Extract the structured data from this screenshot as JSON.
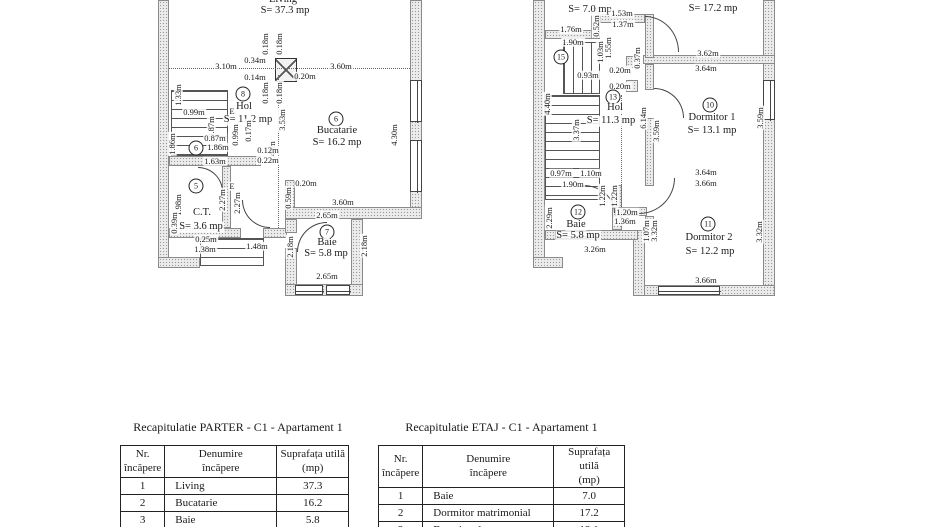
{
  "plans": {
    "parter": {
      "labels": [
        {
          "t": "Living",
          "k": "room",
          "x": 125,
          "y": 0
        },
        {
          "t": "S= 37.3 mp",
          "k": "area",
          "x": 127,
          "y": 11
        },
        {
          "t": "3.10m",
          "k": "dim",
          "x": 68,
          "y": 66
        },
        {
          "t": "0.34m",
          "k": "dim",
          "x": 97,
          "y": 60
        },
        {
          "t": "3.60m",
          "k": "dim",
          "x": 183,
          "y": 66
        },
        {
          "t": "0.14m",
          "k": "dim",
          "x": 97,
          "y": 77
        },
        {
          "t": "0.20m",
          "k": "dim",
          "x": 147,
          "y": 76
        },
        {
          "t": "0.18m",
          "k": "dimv",
          "x": 107,
          "y": 44
        },
        {
          "t": "0.18m",
          "k": "dimv",
          "x": 121,
          "y": 44
        },
        {
          "t": "0.18m",
          "k": "dimv",
          "x": 107,
          "y": 93
        },
        {
          "t": "0.18m",
          "k": "dimv",
          "x": 121,
          "y": 93
        },
        {
          "t": "8",
          "k": "circ",
          "x": 85,
          "y": 94
        },
        {
          "t": "Hol",
          "k": "room",
          "x": 86,
          "y": 107
        },
        {
          "t": "S= 11.2 mp",
          "k": "area",
          "x": 90,
          "y": 120
        },
        {
          "t": "3.53m",
          "k": "dimv",
          "x": 124,
          "y": 120
        },
        {
          "t": "5.45m",
          "k": "dimv",
          "x": 114,
          "y": 152
        },
        {
          "t": "6",
          "k": "circ",
          "x": 178,
          "y": 119
        },
        {
          "t": "Bucatarie",
          "k": "room",
          "x": 179,
          "y": 131
        },
        {
          "t": "S= 16.2 mp",
          "k": "area",
          "x": 179,
          "y": 143
        },
        {
          "t": "4.30m",
          "k": "dimv",
          "x": 236,
          "y": 135
        },
        {
          "t": "1.33m",
          "k": "dimv",
          "x": 20,
          "y": 95
        },
        {
          "t": "0.99m",
          "k": "dim",
          "x": 36,
          "y": 112
        },
        {
          "t": "E",
          "k": "dim",
          "x": 74,
          "y": 111
        },
        {
          "t": "0.87m",
          "k": "dimv",
          "x": 53,
          "y": 127
        },
        {
          "t": "0.87m",
          "k": "dim",
          "x": 57,
          "y": 138
        },
        {
          "t": "1.86m",
          "k": "dimv",
          "x": 14,
          "y": 144
        },
        {
          "t": "6",
          "k": "circ",
          "x": 38,
          "y": 148
        },
        {
          "t": "1.86m",
          "k": "dim",
          "x": 60,
          "y": 147
        },
        {
          "t": "0.99m",
          "k": "dimv",
          "x": 77,
          "y": 135
        },
        {
          "t": "0.17m",
          "k": "dimv",
          "x": 90,
          "y": 131
        },
        {
          "t": "0.12m",
          "k": "dim",
          "x": 110,
          "y": 150
        },
        {
          "t": "0.22m",
          "k": "dim",
          "x": 110,
          "y": 160
        },
        {
          "t": "1.63m",
          "k": "dim",
          "x": 57,
          "y": 161
        },
        {
          "t": "2.27m",
          "k": "dimv",
          "x": 64,
          "y": 200
        },
        {
          "t": "2.27m",
          "k": "dimv",
          "x": 79,
          "y": 203
        },
        {
          "t": "E",
          "k": "dim",
          "x": 74,
          "y": 186
        },
        {
          "t": "1.98m",
          "k": "dimv",
          "x": 20,
          "y": 205
        },
        {
          "t": "0.39m",
          "k": "dimv",
          "x": 16,
          "y": 223
        },
        {
          "t": "5",
          "k": "circ",
          "x": 38,
          "y": 186
        },
        {
          "t": "C.T.",
          "k": "room",
          "x": 44,
          "y": 213
        },
        {
          "t": "S= 3.6 mp",
          "k": "area",
          "x": 43,
          "y": 227
        },
        {
          "t": "0.25m",
          "k": "dim",
          "x": 48,
          "y": 239
        },
        {
          "t": "1.38m",
          "k": "dim",
          "x": 47,
          "y": 249
        },
        {
          "t": "1.48m",
          "k": "dim",
          "x": 99,
          "y": 246
        },
        {
          "t": "0.20m",
          "k": "dim",
          "x": 148,
          "y": 183
        },
        {
          "t": "0.59m",
          "k": "dimv",
          "x": 130,
          "y": 198
        },
        {
          "t": "3.60m",
          "k": "dim",
          "x": 185,
          "y": 202
        },
        {
          "t": "2.65m",
          "k": "dim",
          "x": 169,
          "y": 215
        },
        {
          "t": "7",
          "k": "circ",
          "x": 169,
          "y": 232
        },
        {
          "t": "Baie",
          "k": "room",
          "x": 169,
          "y": 243
        },
        {
          "t": "S= 5.8 mp",
          "k": "area",
          "x": 168,
          "y": 254
        },
        {
          "t": "2.18m",
          "k": "dimv",
          "x": 132,
          "y": 247
        },
        {
          "t": "2.18m",
          "k": "dimv",
          "x": 206,
          "y": 246
        },
        {
          "t": "2.65m",
          "k": "dim",
          "x": 169,
          "y": 276
        }
      ]
    },
    "etaj": {
      "labels": [
        {
          "t": "S= 7.0 mp",
          "k": "area",
          "x": 57,
          "y": 10
        },
        {
          "t": "1.53m",
          "k": "dim",
          "x": 89,
          "y": 13
        },
        {
          "t": "1.37m",
          "k": "dim",
          "x": 90,
          "y": 24
        },
        {
          "t": "S= 17.2 mp",
          "k": "area",
          "x": 180,
          "y": 9
        },
        {
          "t": "1.76m",
          "k": "dim",
          "x": 38,
          "y": 29
        },
        {
          "t": "0.52m",
          "k": "dimv",
          "x": 63,
          "y": 26
        },
        {
          "t": "1.90m",
          "k": "dim",
          "x": 40,
          "y": 42
        },
        {
          "t": "1.03m",
          "k": "dimv",
          "x": 67,
          "y": 52
        },
        {
          "t": "1.55m",
          "k": "dimv",
          "x": 75,
          "y": 48
        },
        {
          "t": "15",
          "k": "circ",
          "x": 28,
          "y": 57
        },
        {
          "t": "3.62m",
          "k": "dim",
          "x": 175,
          "y": 53
        },
        {
          "t": "0.37m",
          "k": "dimv",
          "x": 104,
          "y": 58
        },
        {
          "t": "0.93m",
          "k": "dim",
          "x": 55,
          "y": 75
        },
        {
          "t": "0.20m",
          "k": "dim",
          "x": 87,
          "y": 70
        },
        {
          "t": "3.64m",
          "k": "dim",
          "x": 173,
          "y": 68
        },
        {
          "t": "0.20m",
          "k": "dim",
          "x": 87,
          "y": 86
        },
        {
          "t": "13",
          "k": "circ",
          "x": 80,
          "y": 97
        },
        {
          "t": "Hol",
          "k": "room",
          "x": 82,
          "y": 108
        },
        {
          "t": "S= 11.3 mp",
          "k": "area",
          "x": 78,
          "y": 121
        },
        {
          "t": "10",
          "k": "circ",
          "x": 177,
          "y": 105
        },
        {
          "t": "Dormitor 1",
          "k": "room",
          "x": 179,
          "y": 118
        },
        {
          "t": "S= 13.1 mp",
          "k": "area",
          "x": 179,
          "y": 131
        },
        {
          "t": "6.14m",
          "k": "dimv",
          "x": 110,
          "y": 118
        },
        {
          "t": "3.59m",
          "k": "dimv",
          "x": 123,
          "y": 131
        },
        {
          "t": "3.59m",
          "k": "dimv",
          "x": 227,
          "y": 118
        },
        {
          "t": "4.40m",
          "k": "dimv",
          "x": 14,
          "y": 104
        },
        {
          "t": "3.37m",
          "k": "dimv",
          "x": 43,
          "y": 130
        },
        {
          "t": "0.97m",
          "k": "dim",
          "x": 28,
          "y": 173
        },
        {
          "t": "1.10m",
          "k": "dim",
          "x": 58,
          "y": 173
        },
        {
          "t": "1.90m",
          "k": "dim",
          "x": 40,
          "y": 184
        },
        {
          "t": "3.64m",
          "k": "dim",
          "x": 173,
          "y": 172
        },
        {
          "t": "3.66m",
          "k": "dim",
          "x": 173,
          "y": 183
        },
        {
          "t": "1.22m",
          "k": "dimv",
          "x": 69,
          "y": 196
        },
        {
          "t": "1.22m",
          "k": "dimv",
          "x": 81,
          "y": 196
        },
        {
          "t": "1.20m",
          "k": "dim",
          "x": 94,
          "y": 212
        },
        {
          "t": "1.36m",
          "k": "dim",
          "x": 92,
          "y": 221
        },
        {
          "t": "12",
          "k": "circ",
          "x": 45,
          "y": 212
        },
        {
          "t": "Baie",
          "k": "room",
          "x": 43,
          "y": 225
        },
        {
          "t": "S= 5.8 mp",
          "k": "area",
          "x": 45,
          "y": 236
        },
        {
          "t": "2.29m",
          "k": "dimv",
          "x": 16,
          "y": 218
        },
        {
          "t": "1.07m",
          "k": "dimv",
          "x": 113,
          "y": 231
        },
        {
          "t": "3.32m",
          "k": "dimv",
          "x": 121,
          "y": 231
        },
        {
          "t": "3.32m",
          "k": "dimv",
          "x": 226,
          "y": 232
        },
        {
          "t": "11",
          "k": "circ",
          "x": 175,
          "y": 224
        },
        {
          "t": "Dormitor 2",
          "k": "room",
          "x": 176,
          "y": 238
        },
        {
          "t": "S= 12.2 mp",
          "k": "area",
          "x": 177,
          "y": 252
        },
        {
          "t": "3.26m",
          "k": "dim",
          "x": 62,
          "y": 249
        },
        {
          "t": "3.66m",
          "k": "dim",
          "x": 173,
          "y": 280
        }
      ]
    }
  },
  "tables": {
    "parter": {
      "title": "Recapitulatie PARTER - C1 - Apartament 1",
      "headers": [
        [
          "Nr.",
          "încăpere"
        ],
        [
          "Denumire",
          "încăpere"
        ],
        [
          "Suprafața utilă",
          "(mp)"
        ]
      ],
      "rows": [
        [
          "1",
          "Living",
          "37.3"
        ],
        [
          "2",
          "Bucatarie",
          "16.2"
        ],
        [
          "3",
          "Baie",
          "5.8"
        ]
      ]
    },
    "etaj": {
      "title": "Recapitulatie ETAJ - C1 - Apartament 1",
      "headers": [
        [
          "Nr.",
          "încăpere"
        ],
        [
          "Denumire",
          "încăpere"
        ],
        [
          "Suprafața utilă",
          "(mp)"
        ]
      ],
      "rows": [
        [
          "1",
          "Baie",
          "7.0"
        ],
        [
          "2",
          "Dormitor matrimonial",
          "17.2"
        ],
        [
          "3",
          "Dormitor 1",
          "13.1"
        ]
      ]
    }
  }
}
